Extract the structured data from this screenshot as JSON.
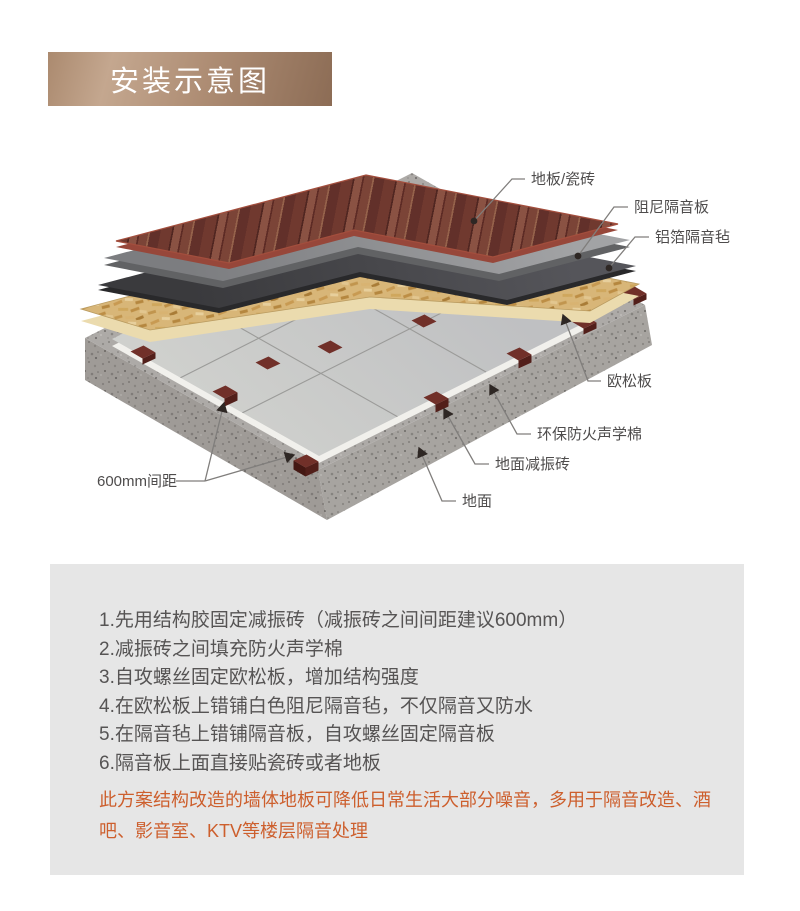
{
  "banner": {
    "title": "安装示意图"
  },
  "diagram": {
    "labels": {
      "floor": "地板/瓷砖",
      "damping_board": "阻尼隔音板",
      "foil_felt": "铝箔隔音毡",
      "osb": "欧松板",
      "acoustic_cotton": "环保防火声学棉",
      "damper_brick": "地面减振砖",
      "ground": "地面",
      "spacing": "600mm间距"
    },
    "layer_colors": {
      "wood_floor": "#70392f",
      "damping_board": "#8f9092",
      "foil_felt": "#3e3e41",
      "osb_board": "#d8b678",
      "acoustic_cotton": "#c7c8c5",
      "damper_brick": "#713029",
      "concrete_slab": "#adaaa7"
    }
  },
  "instructions": {
    "steps": [
      "1.先用结构胶固定减振砖（减振砖之间间距建议600mm）",
      "2.减振砖之间填充防火声学棉",
      "3.自攻螺丝固定欧松板，增加结构强度",
      "4.在欧松板上错铺白色阻尼隔音毡，不仅隔音又防水",
      "5.在隔音毡上错铺隔音板，自攻螺丝固定隔音板",
      "6.隔音板上面直接贴瓷砖或者地板"
    ],
    "note": "此方案结构改造的墙体地板可降低日常生活大部分噪音，多用于隔音改造、酒吧、影音室、KTV等楼层隔音处理",
    "note_color": "#cd5f2d",
    "text_color": "#565454",
    "panel_bg": "#e6e6e6"
  }
}
